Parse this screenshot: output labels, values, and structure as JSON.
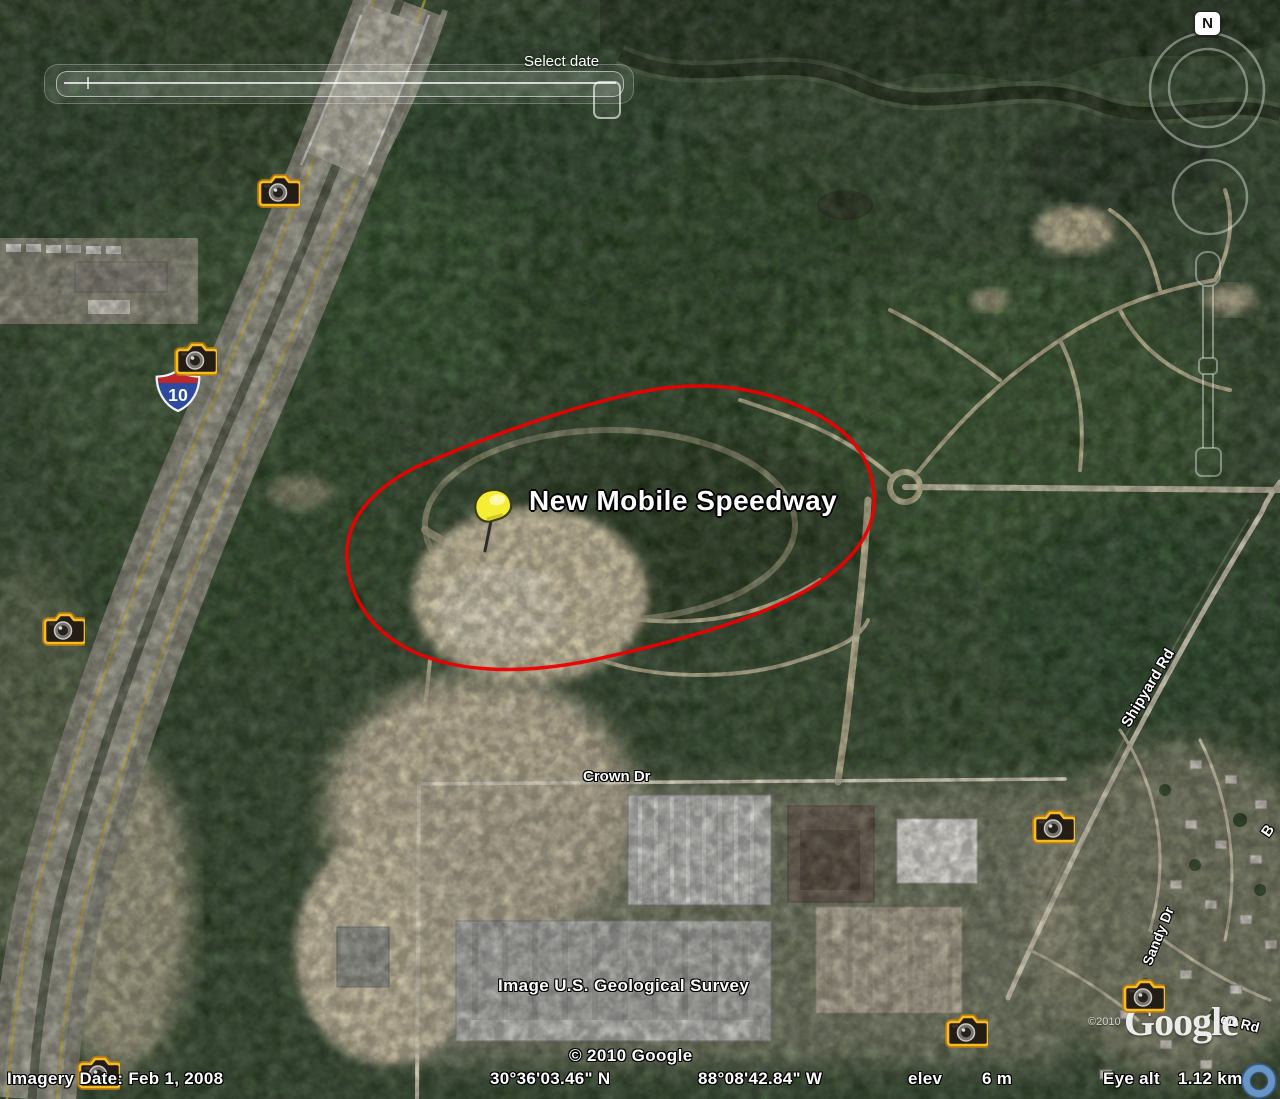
{
  "time_slider": {
    "label": "Select date"
  },
  "navigation": {
    "north_label": "N"
  },
  "map_overlay": {
    "placemark_label": "New Mobile Speedway",
    "shield_route": "10",
    "road_labels": {
      "crown": "Crown Dr",
      "shipyard": "Shipyard Rd",
      "sandy": "Sandy Dr",
      "partial_rd": "ett Rd",
      "partial_b": "B"
    },
    "credits": {
      "usgs": "Image U.S. Geological Survey",
      "google_copyright": "© 2010 Google",
      "small_copyright": "©2010",
      "google_logo": "Google"
    }
  },
  "status_bar": {
    "imagery_date": "Imagery Date: Feb 1, 2008",
    "latitude": "30°36'03.46\" N",
    "longitude": "88°08'42.84\" W",
    "elev_label": "elev",
    "elev_value": "6 m",
    "eye_alt_label": "Eye alt",
    "eye_alt_value": "1.12 km"
  },
  "photo_markers": [
    {
      "x": 278,
      "y": 190
    },
    {
      "x": 195,
      "y": 358
    },
    {
      "x": 63,
      "y": 628
    },
    {
      "x": 1053,
      "y": 826
    },
    {
      "x": 1143,
      "y": 995
    },
    {
      "x": 966,
      "y": 1030
    },
    {
      "x": 98,
      "y": 1072
    }
  ],
  "colors": {
    "speedway_outline": "#ee0000",
    "pushpin": "#f0e532",
    "camera_glow": "#f0a81c",
    "label_text": "#ffffff",
    "interstate_blue": "#2b4aa0",
    "interstate_red": "#c02828"
  }
}
